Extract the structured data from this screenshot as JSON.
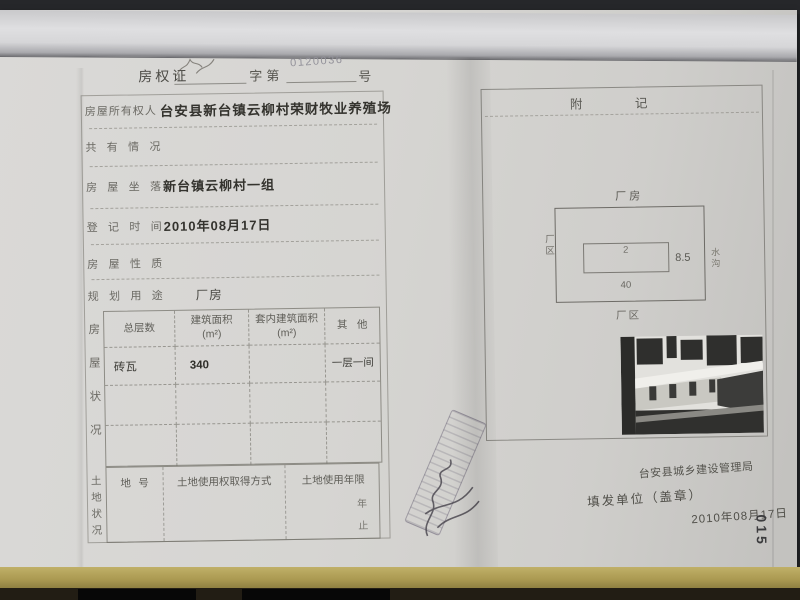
{
  "header": {
    "title": "房权证",
    "zi_di": "字第",
    "number": "0120036",
    "suffix": "号"
  },
  "form": {
    "fields": [
      {
        "label": "房屋所有权人",
        "value": "台安县新台镇云柳村荣财牧业养殖场"
      },
      {
        "label": "共有情况",
        "value": ""
      },
      {
        "label": "房屋坐落",
        "value": "新台镇云柳村一组"
      },
      {
        "label": "登记时间",
        "value": "2010年08月17日"
      },
      {
        "label": "房屋性质",
        "value": ""
      },
      {
        "label": "规划用途",
        "value": "厂房"
      }
    ],
    "house_status": {
      "side_label": "房屋状况",
      "headers": [
        "总层数",
        "建筑面积\n(m²)",
        "套内建筑面积\n(m²)",
        "其他"
      ],
      "rows": [
        [
          "砖瓦",
          "340",
          "",
          "一层一间"
        ],
        [
          "",
          "",
          "",
          ""
        ],
        [
          "",
          "",
          "",
          ""
        ]
      ]
    },
    "land_status": {
      "side_label": "土地状况",
      "headers": [
        "地号",
        "土地使用权取得方式",
        "土地使用年限"
      ],
      "year_start": "年",
      "year_end": "止"
    }
  },
  "annex": {
    "title": "附记",
    "diagram": {
      "top_label": "厂房",
      "left_label": "厂区",
      "right_label": "水沟",
      "bottom_label": "厂区",
      "inner_mark": "2",
      "height_value": "8.5",
      "width_value": "40"
    },
    "issuer": "台安县城乡建设管理局",
    "issue_by_label": "填发单位（盖章）",
    "issue_date": "2010年08月17日",
    "page_code": "015"
  },
  "colors": {
    "paper": "#d6d5d2",
    "desk": "#232427",
    "table_strip": "#ab9a52",
    "label_ink": "#6b6a64",
    "value_ink": "#34332e",
    "stamp_ink": "#6c6678"
  }
}
